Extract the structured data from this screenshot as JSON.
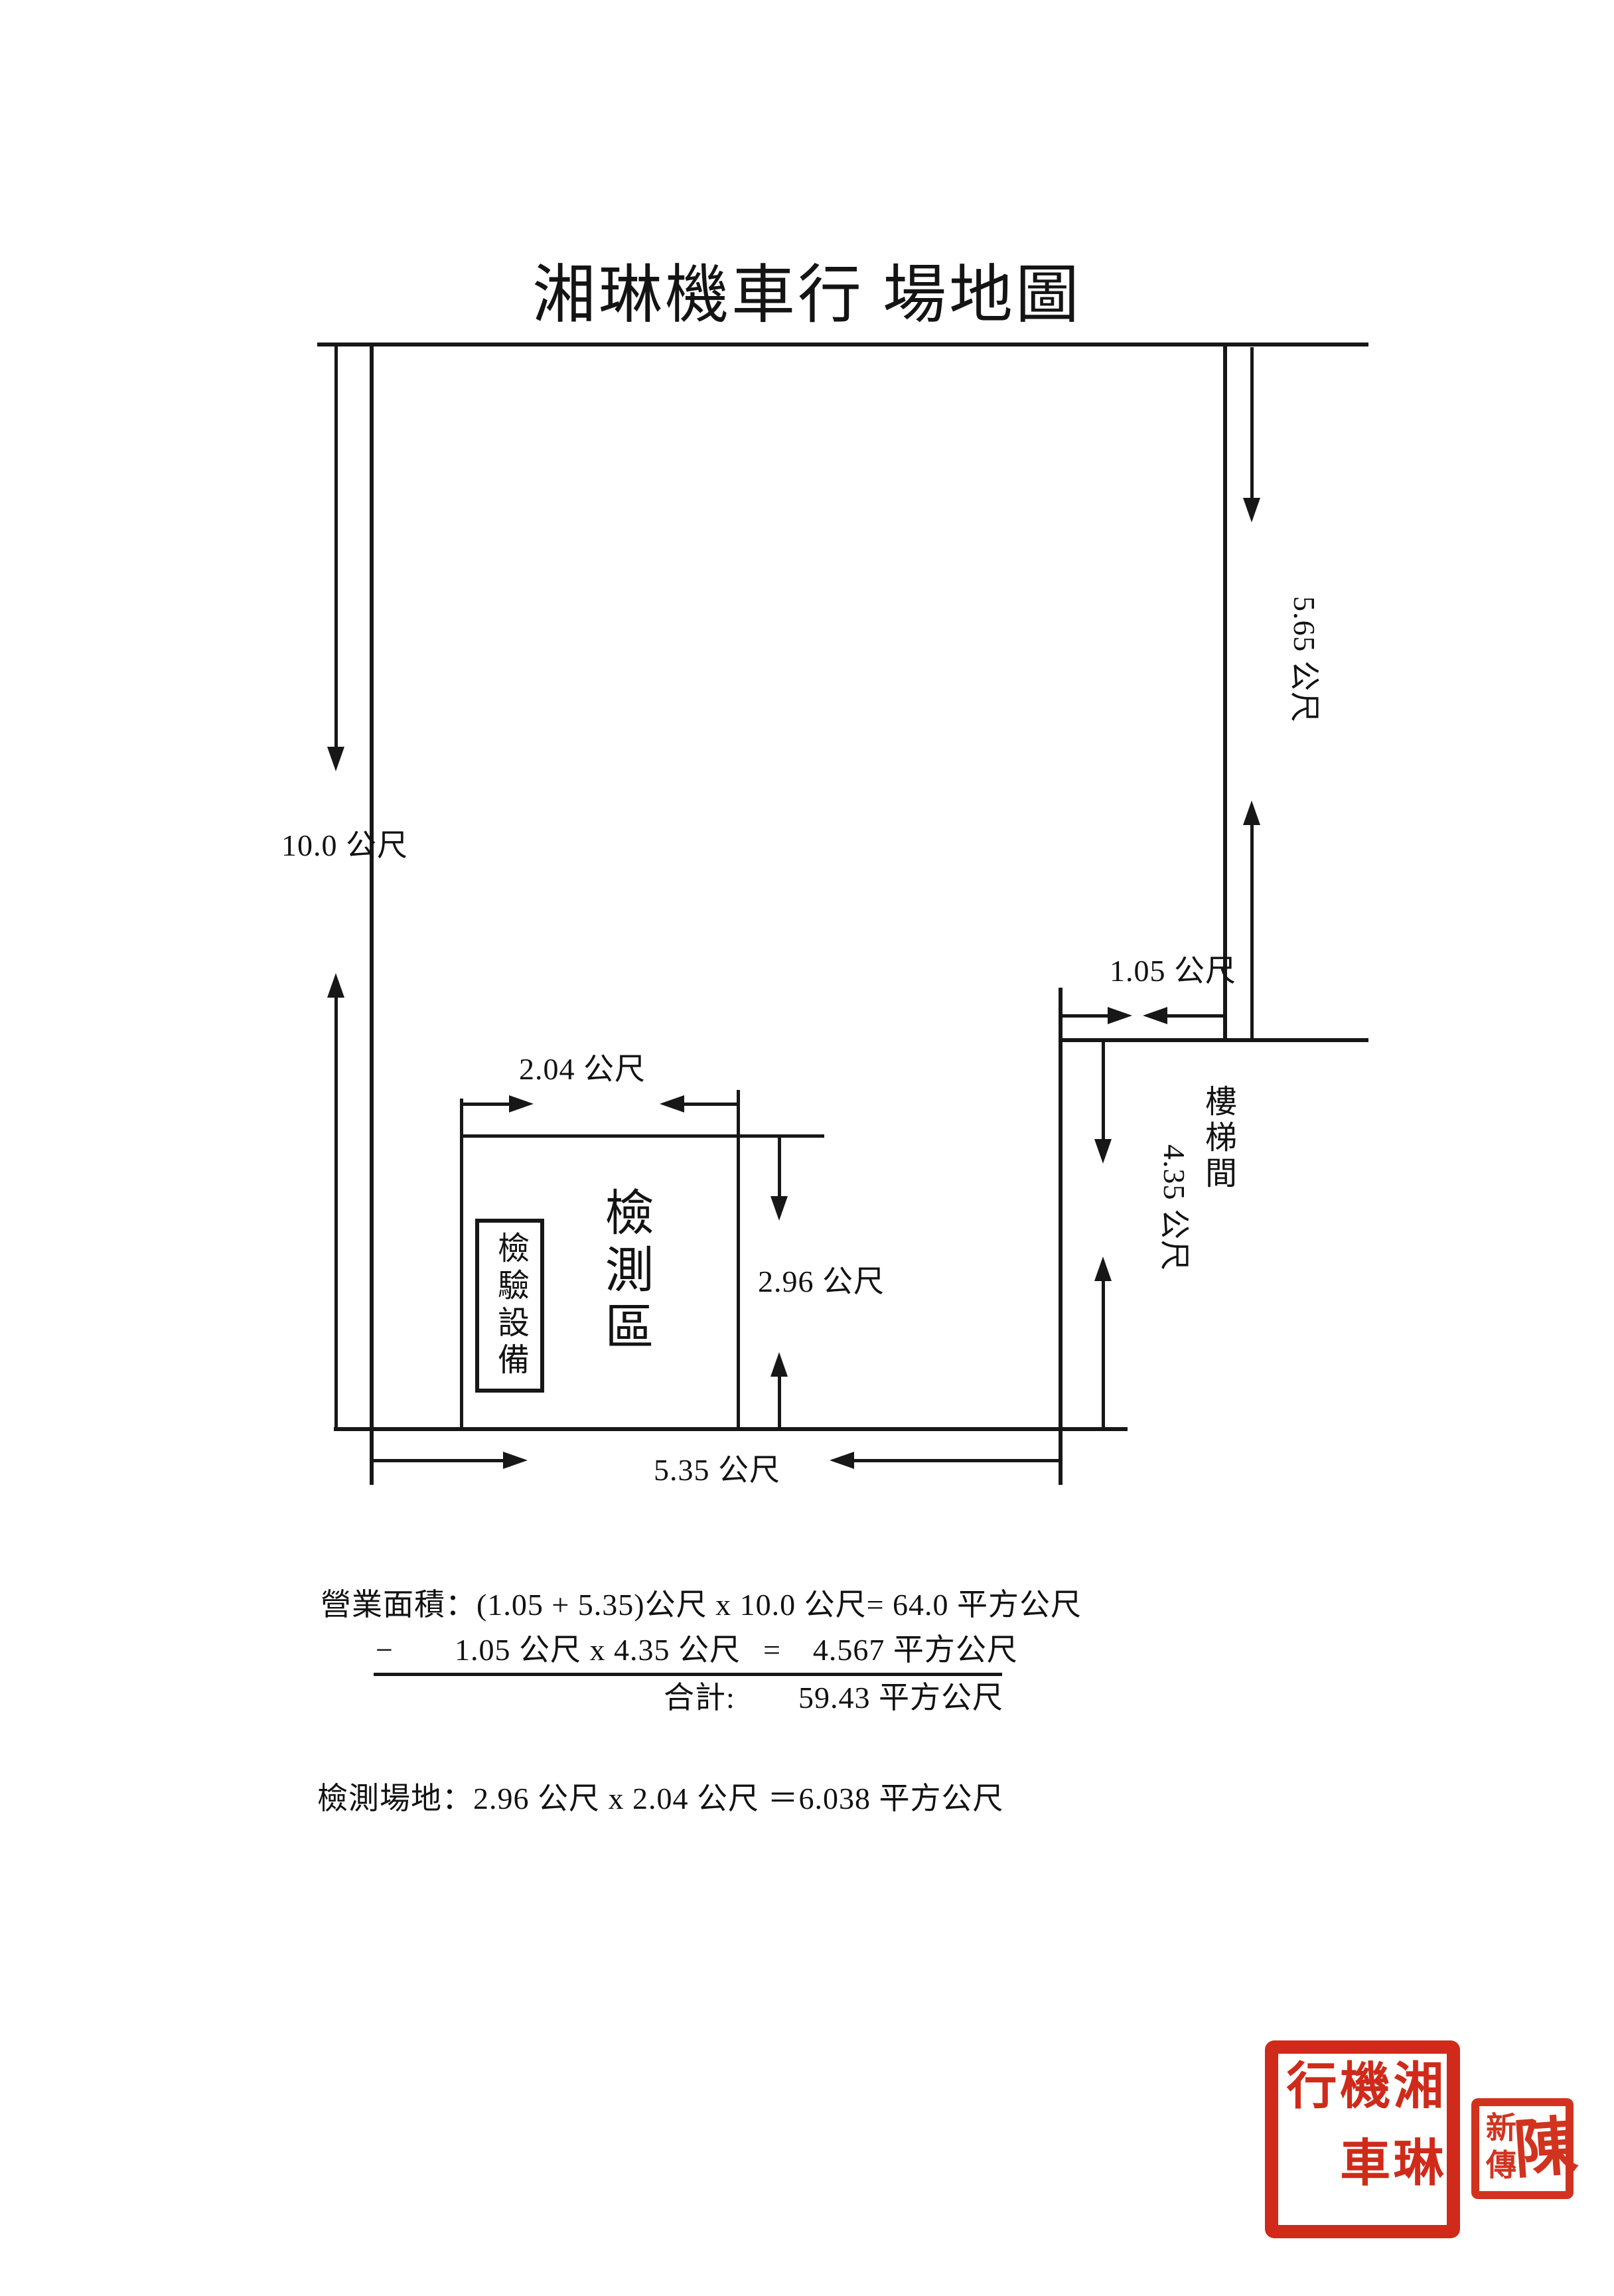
{
  "page": {
    "title": "湘琳機車行 場地圖"
  },
  "floor_plan": {
    "dims": {
      "left_height": "10.0 公尺",
      "right_upper_height": "5.65 公尺",
      "notch_width": "1.05 公尺",
      "notch_height": "4.35 公尺",
      "test_width": "2.04 公尺",
      "test_height": "2.96 公尺",
      "bottom_width": "5.35 公尺"
    },
    "rooms": {
      "stairwell": "樓梯間",
      "test_area": "檢測區",
      "test_equipment": "檢驗設備"
    }
  },
  "calculations": {
    "line1": "營業面積：(1.05 + 5.35)公尺 x 10.0 公尺= 64.0 平方公尺",
    "line2_minus": "−",
    "line2_expression": "1.05 公尺 x 4.35 公尺",
    "line2_equals": "=",
    "line2_result": "4.567 平方公尺",
    "total_label": "合計:",
    "total_value": "59.43 平方公尺",
    "line3": "檢測場地：2.96 公尺 x 2.04 公尺 ＝6.038 平方公尺"
  },
  "seals": {
    "company_seal": "湘琳機車行",
    "name_seal_side": "新傳",
    "name_seal_main": "陳",
    "seal_color": "#cf2a1a"
  }
}
